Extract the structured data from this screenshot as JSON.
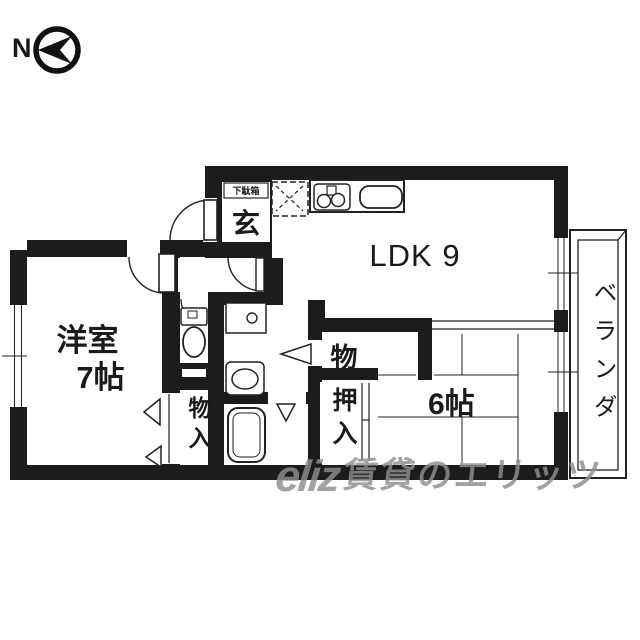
{
  "compass": {
    "label": "N",
    "icon": "compass-north-arrow-icon"
  },
  "entrance": {
    "label": "玄",
    "shoe_cabinet_label": "下駄箱"
  },
  "rooms": {
    "ldk": {
      "label": "LDK 9"
    },
    "western": {
      "name": "洋室",
      "size": "7帖"
    },
    "tatami": {
      "label": "6帖"
    },
    "veranda": {
      "label": "ベランダ"
    }
  },
  "closets": {
    "mono": {
      "label": "物"
    },
    "oshiire": {
      "label": "押入"
    },
    "monoire": {
      "label": "物入"
    }
  },
  "fixtures": {
    "icons": [
      "refrigerator-space-icon",
      "stove-icon",
      "kitchen-sink-icon",
      "toilet-icon",
      "washing-machine-pan-icon",
      "washbasin-icon",
      "bathtub-icon",
      "door-arc-icon",
      "window-icon",
      "sliding-door-icon"
    ]
  },
  "watermark": {
    "logo": "eliz",
    "text": "賃貸のエリッツ"
  },
  "colors": {
    "wall": "#1c1c1c",
    "line": "#222222",
    "watermark": "#8e8e8e"
  }
}
